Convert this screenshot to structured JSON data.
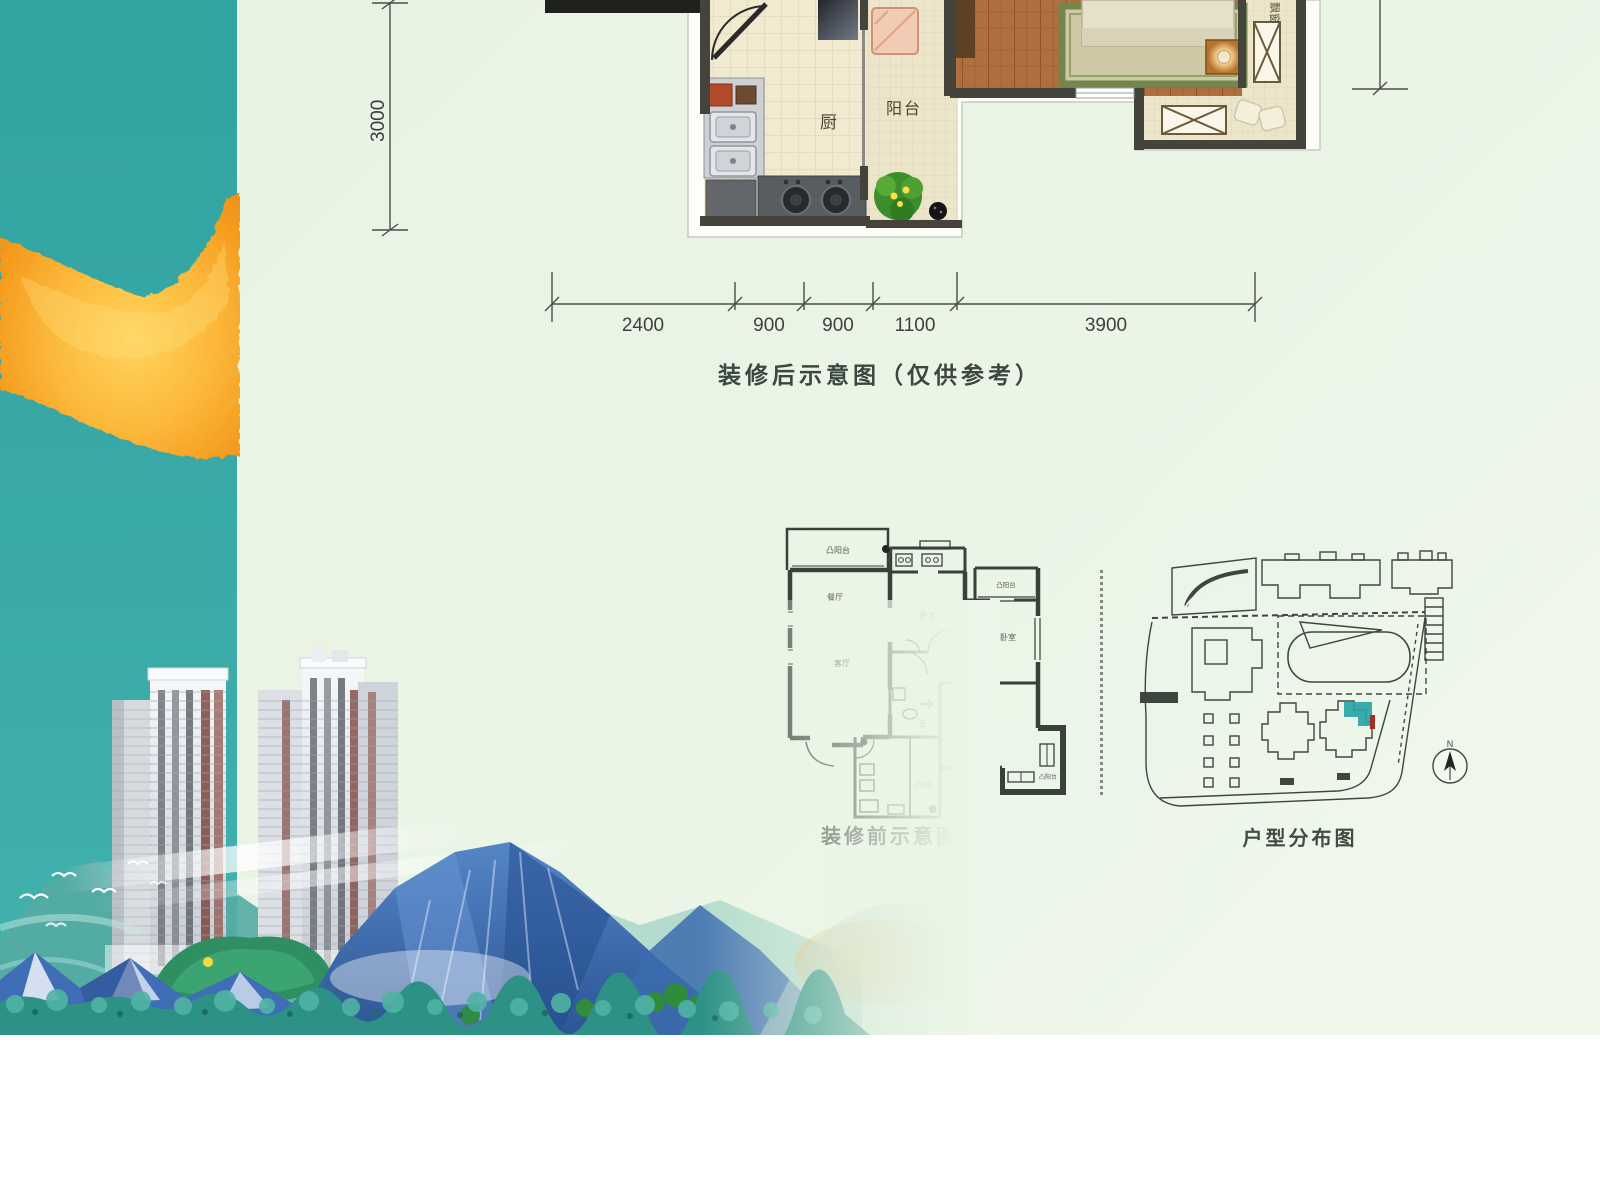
{
  "poster": {
    "after_plan": {
      "caption": "装修后示意图（仅供参考）",
      "labels": {
        "kitchen": "厨",
        "balcony": "阳台",
        "bay_window": "飘窗"
      },
      "dimensions": {
        "left": "3000",
        "bottom": [
          "2400",
          "900",
          "900",
          "1100",
          "3900"
        ]
      }
    },
    "before_plan": {
      "caption": "装修前示意图",
      "room_labels": [
        "凸阳台",
        "餐厅",
        "客厅",
        "卧室",
        "凸阳台",
        "卧室",
        "卫",
        "卧室",
        "凸阳台",
        "凸阳台"
      ]
    },
    "site_plan": {
      "caption": "户型分布图",
      "compass": "N"
    },
    "colors": {
      "teal_band": "#3aaba8",
      "gold_stroke": "#f7a81f",
      "background": "#eaf5e6",
      "wall": "#44443c",
      "ink": "#3b4841",
      "highlight_unit": "#2ba3a4"
    }
  }
}
